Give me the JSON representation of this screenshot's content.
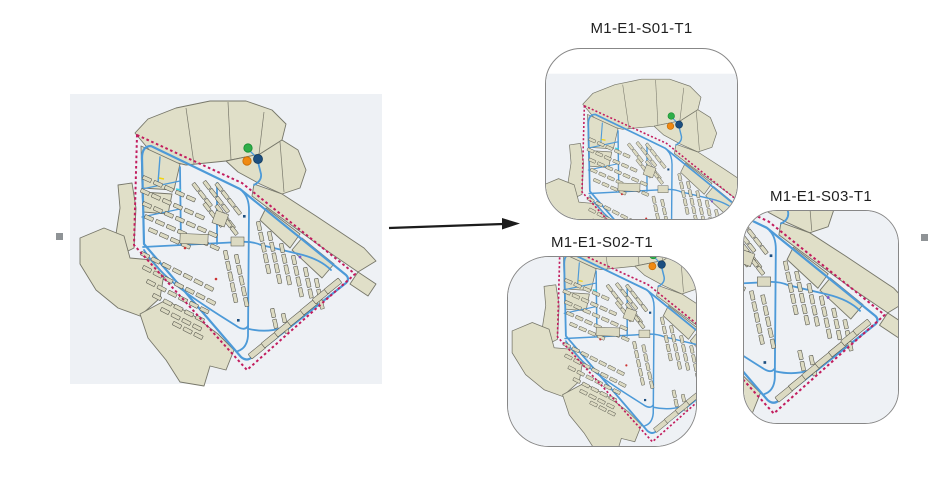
{
  "figure": {
    "boxes": [
      {
        "title": "M1-E1-S01-T1"
      },
      {
        "title": "M1-E1-S02-T1"
      },
      {
        "title": "M1-E1-S03-T1"
      }
    ]
  },
  "theme": {
    "page_bg": "#ffffff",
    "map_bg": "#eef1f5",
    "land": "#e0dfc8",
    "land_stroke": "#77776a",
    "building": "#dcdac2",
    "building_stroke": "#55554c",
    "road": "#4d9ad8",
    "boundary": "#c21d5e",
    "marker_green": "#2fae49",
    "marker_orange": "#f08a12",
    "marker_navy": "#1d4f80",
    "accent_red": "#cc3333",
    "accent_purple": "#7e57c2",
    "accent_yellow": "#f2d410",
    "accent_cyan": "#3fd0e0",
    "arrow_color": "#1c1c1c",
    "frame_border": "#878787",
    "caption_color": "#1f1f1f",
    "handle_color": "#8f9396"
  }
}
